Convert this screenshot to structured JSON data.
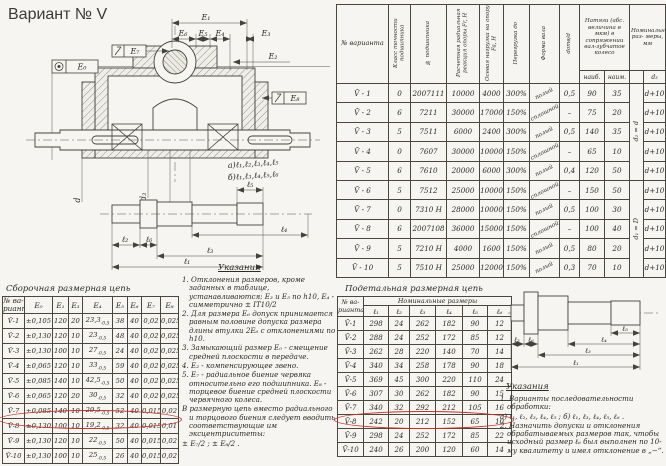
{
  "page_title": "Вариант № V",
  "annotation_color": "#c2342a",
  "drawing": {
    "dims": {
      "e0": "Е₀",
      "e1": "Е₁",
      "e2": "Е₂",
      "e3": "Е₃",
      "e4": "Е₄",
      "e5": "Е₅",
      "e6": "Е₆",
      "e7": "Е₇",
      "e8": "Е₈"
    },
    "diameters": {
      "d": "d",
      "d3": "d₃",
      "d2": "d₂",
      "D": "D"
    },
    "seq_a": "а)ℓ₁,ℓ₂,ℓ₃,ℓ₄,ℓ₅",
    "seq_b": "б)ℓ₁,ℓ₃,ℓ₄,ℓ₅,ℓ₆",
    "lengths": {
      "l1": "ℓ₁",
      "l2": "ℓ₂",
      "l3": "ℓ₃",
      "l4": "ℓ₄",
      "l5": "ℓ₅",
      "l6": "ℓ₆"
    }
  },
  "variants_table": {
    "headers": {
      "variant": "№ варианта",
      "accuracy": "Класс точности подшипника",
      "bearing": "№ подшипника",
      "radial": "Расчетная радиальная реакция опоры Fr, Н",
      "axial": "Осевая нагрузка на опору Fa, Н",
      "overload": "Перегрузка до",
      "shaft_form": "Форма вала",
      "dratio": "dотв/d",
      "natyagi": "Натяги (абс. величина в мкм) в сопряжении вал-зубчатое колесо",
      "max": "наиб.",
      "min": "наим.",
      "nominal": "Номинальные раз- меры, мм",
      "d3": "d₃"
    },
    "rows": [
      [
        "V̄ - 1",
        "0",
        "2007111",
        "10000",
        "4000",
        "300%",
        {
          "v": "полый",
          "cls": "diag"
        },
        "0,5",
        "90",
        "35",
        {
          "v": "d₂ = d",
          "rowspan": 5,
          "cls": "rotv"
        },
        "d+10"
      ],
      [
        "V̄ - 2",
        "6",
        "7211",
        "30000",
        "17000",
        "150%",
        {
          "v": "сплошной",
          "cls": "diag"
        },
        "–",
        "75",
        "20",
        null,
        "d+10"
      ],
      [
        "V̄ - 3",
        "5",
        "7511",
        "6000",
        "2400",
        "300%",
        {
          "v": "полый",
          "cls": "diag"
        },
        "0,5",
        "140",
        "35",
        null,
        "d+10"
      ],
      [
        "V̄ - 4",
        "0",
        "7607",
        "30000",
        "10000",
        "150%",
        {
          "v": "сплошной",
          "cls": "diag"
        },
        "–",
        "65",
        "10",
        null,
        "d+10"
      ],
      [
        "V̄ - 5",
        "6",
        "7610",
        "20000",
        "6000",
        "300%",
        {
          "v": "полый",
          "cls": "diag"
        },
        "0,4",
        "120",
        "50",
        null,
        "d+10"
      ],
      [
        "V̄ - 6",
        "5",
        "7512",
        "25000",
        "10000",
        "150%",
        {
          "v": "сплошной",
          "cls": "diag"
        },
        "–",
        "150",
        "50",
        {
          "v": "d₁ = D",
          "rowspan": 5,
          "cls": "rotv"
        },
        "d+10"
      ],
      [
        "V̄ - 7",
        "0",
        "7310 Н",
        "28000",
        "10000",
        "150%",
        {
          "v": "полый",
          "cls": "diag"
        },
        "0,5",
        "100",
        "30",
        null,
        "d+10"
      ],
      [
        "V̄ - 8",
        "6",
        "2007108",
        "36000",
        "15000",
        "150%",
        {
          "v": "сплошной",
          "cls": "diag"
        },
        "–",
        "100",
        "40",
        null,
        "d+10"
      ],
      [
        "V̄ - 9",
        "5",
        "7210 Н",
        "4000",
        "1600",
        "150%",
        {
          "v": "полый",
          "cls": "diag"
        },
        "0,5",
        "80",
        "20",
        null,
        "d+10"
      ],
      [
        "V̄ - 10",
        "5",
        "7510 Н",
        "25000",
        "12000",
        "150%",
        {
          "v": "полый",
          "cls": "diag"
        },
        "0,3",
        "70",
        "10",
        null,
        "d+10"
      ]
    ]
  },
  "asm_chain": {
    "title": "Сборочная размерная цепь",
    "headers": [
      "№ ва-\nрианта",
      "Е₀",
      "Е₁",
      "Е₃",
      "Е₄",
      "Е₅",
      "Е₆",
      "Е₇",
      "Е₈"
    ],
    "rows": [
      [
        "V̄-1",
        "±0,105",
        "120",
        "20",
        {
          "v": "23,3",
          "sub": "-0,5"
        },
        "38",
        "40",
        "0,02",
        "0,025"
      ],
      [
        "V̄-2",
        "±0,130",
        "120",
        "10",
        {
          "v": "23",
          "sub": "-0,5"
        },
        "48",
        "40",
        "0,02",
        "0,025"
      ],
      [
        "V̄-3",
        "±0,130",
        "100",
        "10",
        {
          "v": "27",
          "sub": "-0,5"
        },
        "24",
        "40",
        "0,02",
        "0,025"
      ],
      [
        "V̄-4",
        "±0,065",
        "120",
        "10",
        {
          "v": "33",
          "sub": "-0,5"
        },
        "59",
        "40",
        "0,02",
        "0,025"
      ],
      [
        "V̄-5",
        "±0,085",
        "140",
        "10",
        {
          "v": "42,5",
          "sub": "-0,5"
        },
        "50",
        "40",
        "0,02",
        "0,025"
      ],
      [
        "V̄-6",
        "±0,065",
        "120",
        "20",
        {
          "v": "30",
          "sub": "-0,5"
        },
        "32",
        "40",
        "0,02",
        "0,025"
      ],
      [
        "V̄-7",
        "±0,085",
        "140",
        "10",
        {
          "v": "29,5",
          "sub": "-0,5"
        },
        "52",
        "40",
        "0,015",
        "0,02"
      ],
      [
        "V̄-8",
        "±0,130",
        "100",
        "10",
        {
          "v": "19,2",
          "sub": "-0,5"
        },
        "32",
        "40",
        "0,015",
        "0,01"
      ],
      [
        "V̄-9",
        "±0,130",
        "120",
        "10",
        {
          "v": "22",
          "sub": "-0,5"
        },
        "50",
        "40",
        "0,015",
        "0,02"
      ],
      [
        "V̄-10",
        "±0,130",
        "100",
        "10",
        {
          "v": "25",
          "sub": "-0,5"
        },
        "26",
        "40",
        "0,015",
        "0,02"
      ]
    ]
  },
  "notes_left": {
    "title": "Указания",
    "items": [
      "1. Отклонения размеров, кроме заданных в таблице, устанавливаются: Е₃ и Е₅ по h10, Е₄ - симметрично ± IT10/2",
      "2. Для размера Е₆ допуск принимается равным половине допуска размера длины втулки 2Е₆ с отклонениями по h10.",
      "3. Замыкающий размер Е₀ - смещение средней плоскости в передаче.",
      "4. Е₂ - компенсирующее звено.",
      "5. Е₇ - радиальное биение червяка относительно его подшипника. Е₈ - торцевое биение средней плоскости червячного колеса.",
      "В размерную цепь вместо радиального и торцового биения следует вводить соответствующие им эксцентриситеты:",
      "± Е₇/2 ;      ± Е₈/2 ."
    ]
  },
  "detail_chain": {
    "title": "Подетальная размерная цепь",
    "group_header": "Номинальные размеры",
    "headers": [
      "№ ва-\nрианта",
      "ℓ₁",
      "ℓ₂",
      "ℓ₃",
      "ℓ₄",
      "ℓ₅",
      "ℓ₆"
    ],
    "rows": [
      [
        "V̄-1",
        "298",
        "24",
        "262",
        "182",
        "90",
        "12"
      ],
      [
        "V̄-2",
        "288",
        "24",
        "252",
        "172",
        "85",
        "12"
      ],
      [
        "V̄-3",
        "262",
        "28",
        "220",
        "140",
        "70",
        "14"
      ],
      [
        "V̄-4",
        "340",
        "34",
        "258",
        "178",
        "90",
        "18"
      ],
      [
        "V̄-5",
        "369",
        "45",
        "300",
        "220",
        "110",
        "24"
      ],
      [
        "V̄-6",
        "307",
        "30",
        "262",
        "182",
        "90",
        "15"
      ],
      [
        "V̄-7",
        "340",
        "32",
        "292",
        "212",
        "105",
        "16"
      ],
      [
        "V̄-8",
        "242",
        "20",
        "212",
        "152",
        "65",
        "10"
      ],
      [
        "V̄-9",
        "298",
        "24",
        "252",
        "172",
        "85",
        "22"
      ],
      [
        "V̄-10",
        "240",
        "26",
        "200",
        "120",
        "60",
        "14"
      ]
    ]
  },
  "notes_right": {
    "title": "Указания",
    "items": [
      "1. Варианты последовательности обработки:",
      "а) ℓ₁, ℓ₂, ℓ₃, ℓ₄, ℓ₅ ;    б) ℓ₁, ℓ₃, ℓ₄, ℓ₅, ℓ₆ .",
      "2. Назначить допуски и отклонения обрабатываемых размеров так, чтобы исходный размер ℓ₆ был выполнен по 10-му квалитету и имел отклонение в „−“."
    ]
  }
}
